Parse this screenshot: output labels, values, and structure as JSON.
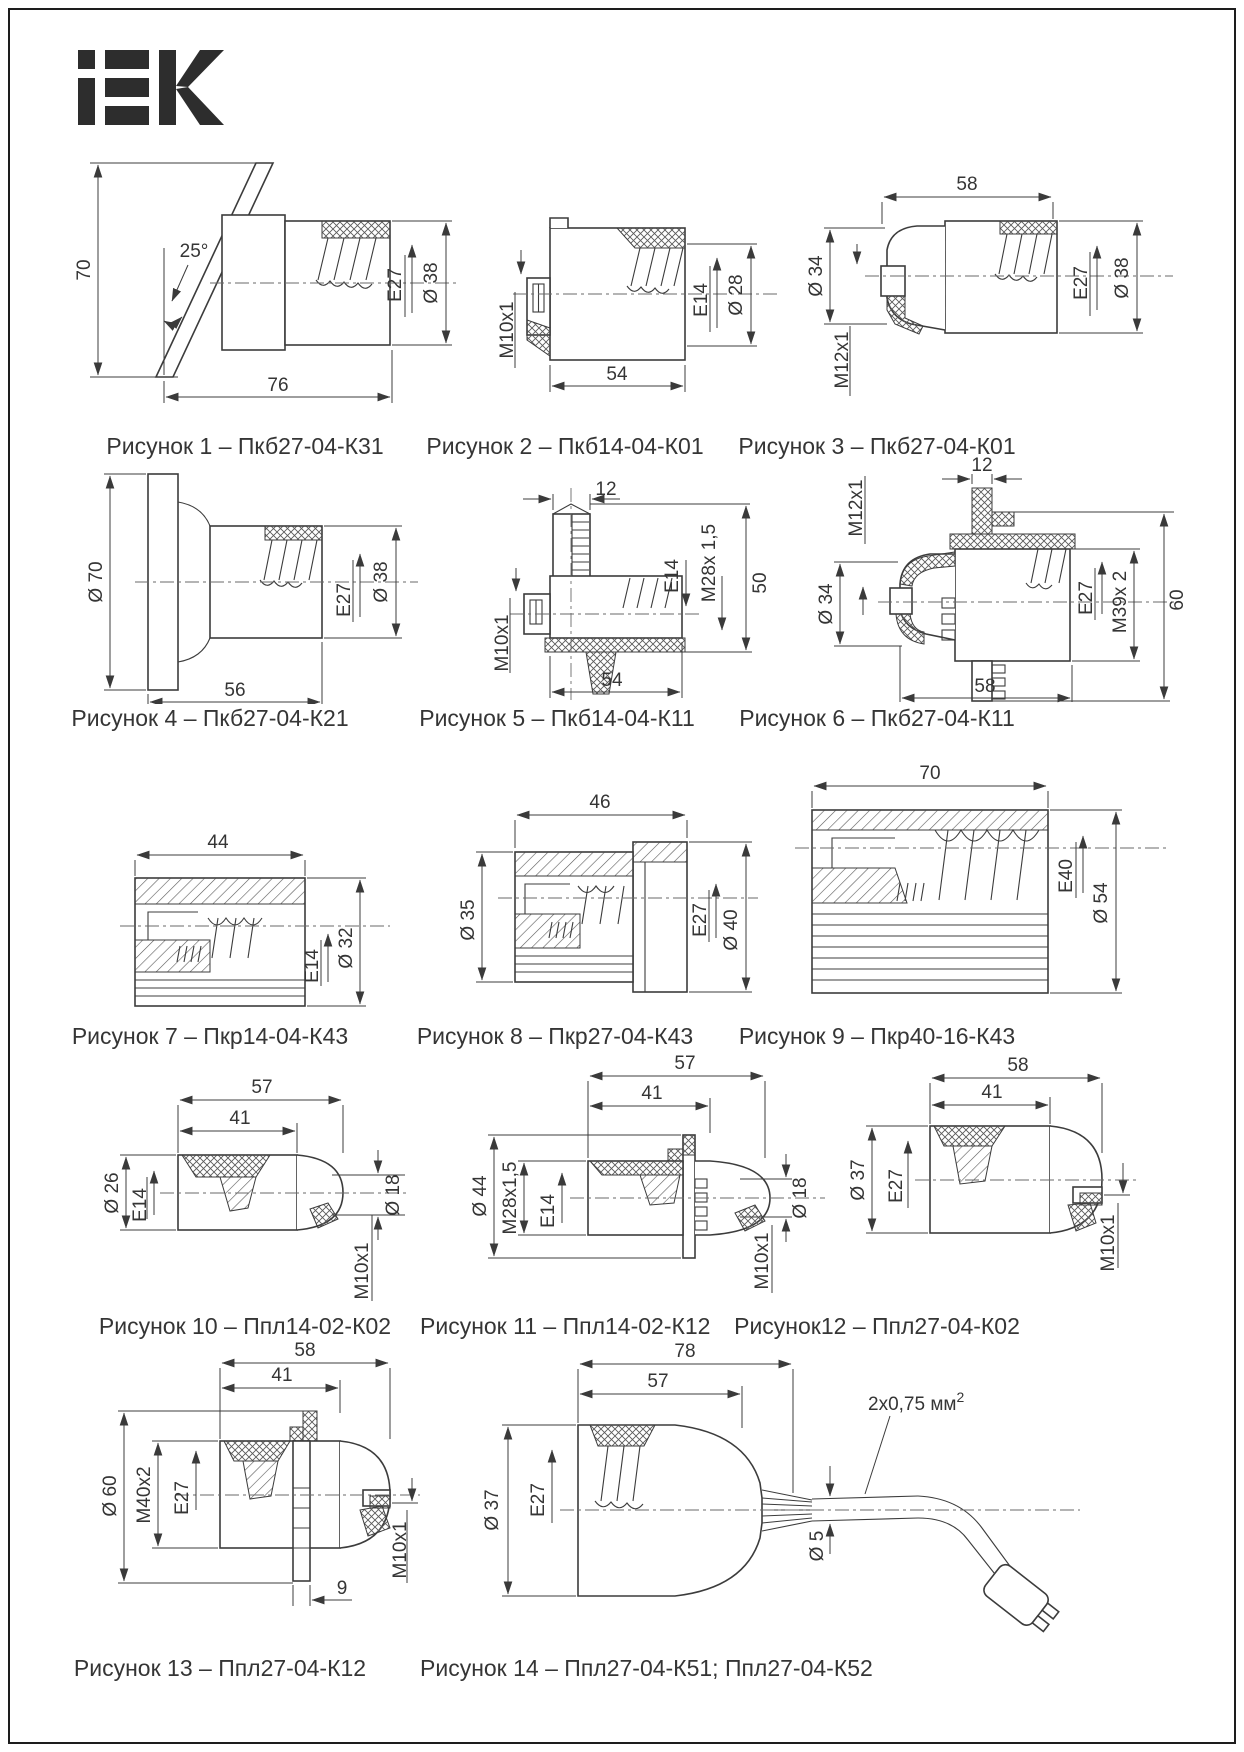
{
  "logo_text": "iEK",
  "figures": [
    {
      "caption": "Рисунок 1 – Пкб27-04-К31",
      "labels": {
        "vert": "70",
        "angle": "25°",
        "len": "76",
        "socket": "E27",
        "dia": "Ø 38"
      }
    },
    {
      "caption": "Рисунок 2 – Пкб14-04-К01",
      "labels": {
        "thread": "M10x1",
        "len": "54",
        "socket": "E14",
        "dia": "Ø 28"
      }
    },
    {
      "caption": "Рисунок 3 – Пкб27-04-К01",
      "labels": {
        "len": "58",
        "dia_l": "Ø 34",
        "thread": "M12x1",
        "socket": "E27",
        "dia_r": "Ø 38"
      }
    },
    {
      "caption": "Рисунок 4 – Пкб27-04-К21",
      "labels": {
        "dia_l": "Ø 70",
        "len": "56",
        "socket": "E27",
        "dia_r": "Ø 38"
      }
    },
    {
      "caption": "Рисунок 5 – Пкб14-04-К11",
      "labels": {
        "top": "12",
        "thread": "M10x1",
        "len": "54",
        "socket": "E14",
        "thread2": "M28x 1,5",
        "vert": "50"
      }
    },
    {
      "caption": "Рисунок 6 – Пкб27-04-К11",
      "labels": {
        "thread": "M12x1",
        "top": "12",
        "dia_l": "Ø 34",
        "socket": "E27",
        "thread2": "M39x 2",
        "vert": "60",
        "len": "58"
      }
    },
    {
      "caption": "Рисунок 7 – Пкр14-04-К43",
      "labels": {
        "len": "44",
        "socket": "E14",
        "dia": "Ø 32"
      }
    },
    {
      "caption": "Рисунок 8 – Пкр27-04-К43",
      "labels": {
        "len": "46",
        "dia_l": "Ø 35",
        "socket": "E27",
        "dia_r": "Ø 40"
      }
    },
    {
      "caption": "Рисунок 9 – Пкр40-16-К43",
      "labels": {
        "len": "70",
        "socket": "E40",
        "dia": "Ø 54"
      }
    },
    {
      "caption": "Рисунок 10 – Ппл14-02-К02",
      "labels": {
        "len1": "57",
        "len2": "41",
        "dia_l": "Ø 26",
        "socket": "E14",
        "dia_r": "Ø 18",
        "thread": "M10x1"
      }
    },
    {
      "caption": "Рисунок 11 – Ппл14-02-К12",
      "labels": {
        "len1": "57",
        "len2": "41",
        "dia_l": "Ø 44",
        "thread2": "M28x1,5",
        "socket": "E14",
        "dia_r": "Ø 18",
        "thread": "M10x1"
      }
    },
    {
      "caption": "Рисунок12 – Ппл27-04-К02",
      "labels": {
        "len1": "58",
        "len2": "41",
        "dia_l": "Ø 37",
        "socket": "E27",
        "thread": "M10x1"
      }
    },
    {
      "caption": "Рисунок 13 – Ппл27-04-К12",
      "labels": {
        "len1": "58",
        "len2": "41",
        "dia_l": "Ø 60",
        "thread2": "M40x2",
        "socket": "E27",
        "thread": "M10x1",
        "t": "9"
      }
    },
    {
      "caption": "Рисунок 14 – Ппл27-04-К51; Ппл27-04-К52",
      "labels": {
        "len1": "78",
        "len2": "57",
        "dia_l": "Ø 37",
        "socket": "E27",
        "cable": "2x0,75 мм",
        "cable_sup": "2",
        "dia_c": "Ø 5"
      }
    }
  ]
}
